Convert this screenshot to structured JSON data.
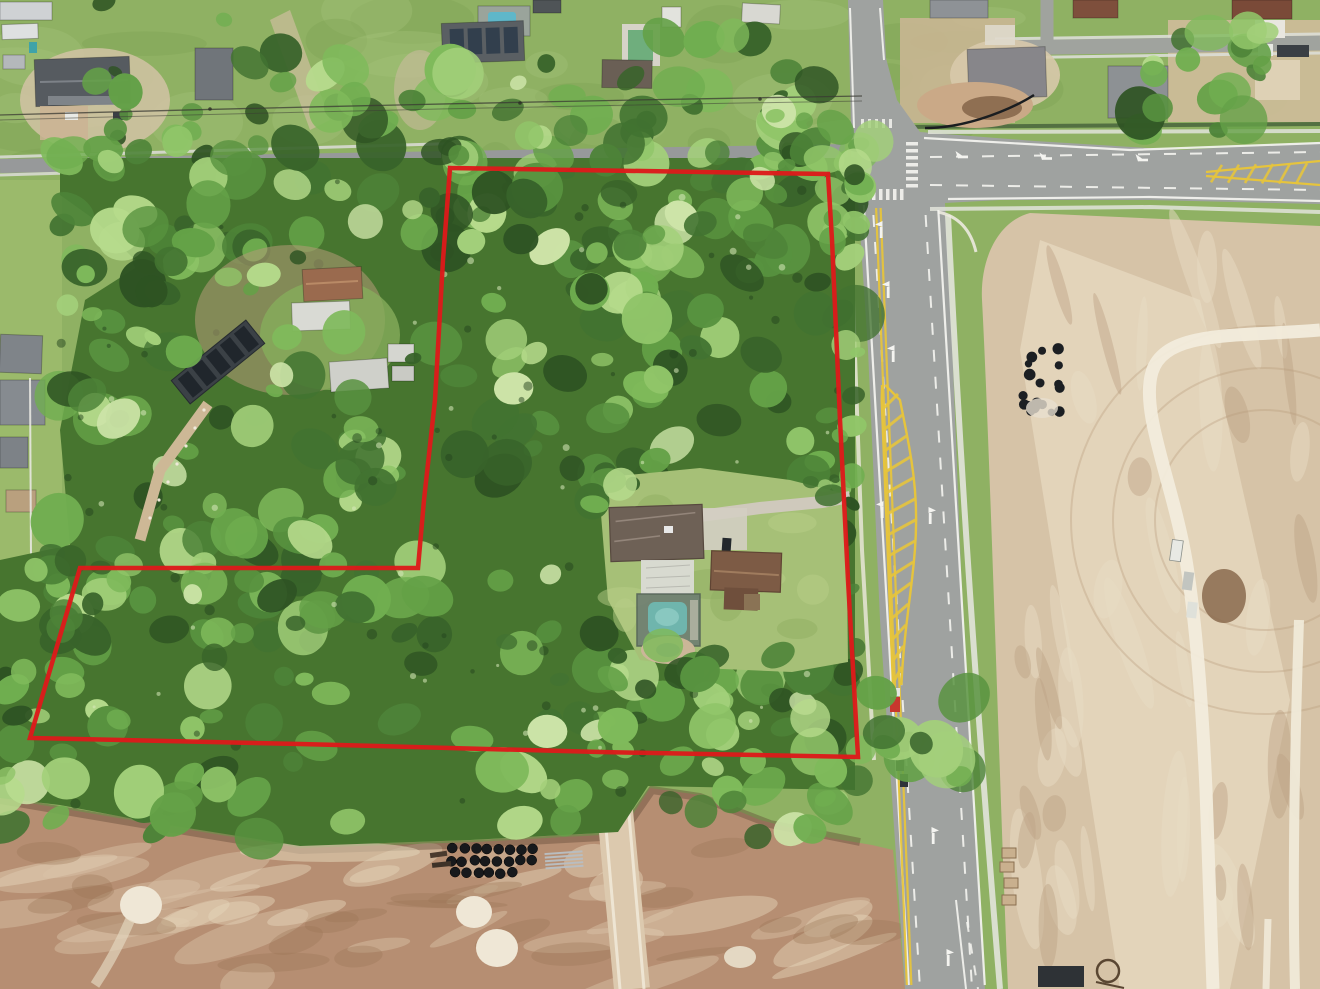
{
  "image": {
    "kind": "aerial-drone-photograph",
    "subject": "Heavily wooded residential land parcel outlined in red, bordered by an established neighborhood (top/left), a new divided roadway (right) and cleared construction dirt (right and bottom)",
    "width_px": 1320,
    "height_px": 989,
    "visible_text": "none"
  },
  "parcel_outline": {
    "color": "#dd1a1a",
    "stroke_width": 4.5,
    "points": [
      [
        450,
        168
      ],
      [
        828,
        174
      ],
      [
        832,
        240
      ],
      [
        840,
        420
      ],
      [
        848,
        580
      ],
      [
        858,
        757
      ],
      [
        600,
        752
      ],
      [
        300,
        744
      ],
      [
        30,
        738
      ],
      [
        80,
        568
      ],
      [
        418,
        568
      ],
      [
        424,
        500
      ],
      [
        435,
        400
      ],
      [
        443,
        260
      ],
      [
        450,
        168
      ]
    ]
  },
  "scene_inventory": {
    "parcel": {
      "cover": "dense tree canopy",
      "structures": [
        "main house with shingle roof",
        "screened lanai",
        "screened pool enclosure with pool",
        "guest house with brown roof",
        "concrete driveway",
        "paver garden"
      ]
    },
    "roads": {
      "main_road": "new two-way divided road running north-south with yellow cross-hatched median, turn arrows and crosswalks",
      "cross_road": "new east-west road with yellow cross-hatched median",
      "residential_street": "older street entering intersection from the west"
    },
    "construction": {
      "right_pad": "large graded sand pad with white limerock base track and vehicles",
      "bottom_strip": "brown graded dirt with stacked black culvert pipes, metal pipes, white sand patches and a dirt haul track",
      "pipe_pile_right": "pile of black pipes on sand"
    },
    "neighborhood_top_left": [
      "mobile homes",
      "house under construction with dark roof",
      "homes with pools",
      "house with rooftop solar panels",
      "long solar panel carport",
      "trailers and sheds"
    ],
    "neighborhood_top_right": [
      "new construction homes",
      "dirt lots",
      "street with parked work trucks"
    ]
  },
  "palette": {
    "grass": "#8fb163",
    "grass_light": "#a9c77d",
    "grass_dark": "#7ba050",
    "lawn_clearing": "#a6c077",
    "canopy_base": "#47752f",
    "asphalt": "#9fa2a0",
    "asphalt_old": "#97999a",
    "sidewalk": "#e2e4da",
    "curb": "#eceadf",
    "road_white": "#f4f4f0",
    "road_yellow": "#e6c43c",
    "dirt_bottom": "#b68e72",
    "dirt_bottom_light": "#d9c4a8",
    "dirt_pad": "#d6c3a7",
    "dirt_pad_light": "#e7dac0",
    "sand_white": "#efe7d6",
    "track_white": "#f2ecdc",
    "pool_teal": "#6fb5ad",
    "pool_blue": "#5fb7c9",
    "pool_green": "#6fae7d",
    "roof_dark": "#565b60",
    "roof_main_house": "#6e6156",
    "roof_guest_house": "#7d5b45",
    "lanai_white": "#dadbd5",
    "pipe_black": "#17191c",
    "hedge_dark": "#44603a"
  }
}
